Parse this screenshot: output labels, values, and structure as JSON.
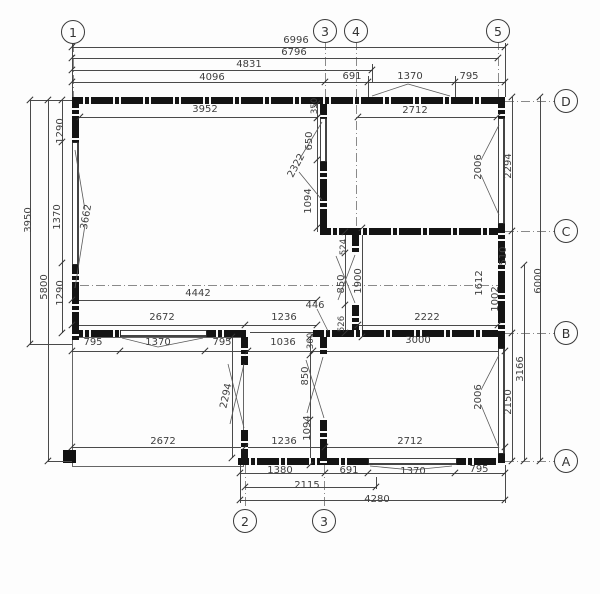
{
  "drawing_type": "floor-plan",
  "grid": {
    "g1": "1",
    "g3": "3",
    "g4": "4",
    "g5": "5",
    "b2": "2",
    "b3": "3",
    "rD": "D",
    "rC": "C",
    "rB": "B",
    "rA": "A"
  },
  "dims": {
    "t6996": "6996",
    "t6796": "6796",
    "t4831": "4831",
    "t4096": "4096",
    "t691": "691",
    "t1370": "1370",
    "t795": "795",
    "t3952": "3952",
    "t2712": "2712",
    "l3950": "3950",
    "l5800": "5800",
    "l1290a": "1290",
    "l1370": "1370",
    "l1290b": "1290",
    "l3662": "3662",
    "c350": "350",
    "c650": "650",
    "c2322": "2322",
    "c1094": "1094",
    "m524": "524",
    "m850": "850",
    "m526": "526",
    "m1900": "1900",
    "m446": "446",
    "m1612": "1612",
    "r2006a": "2006",
    "r2294": "2294",
    "r510": "510",
    "r1002": "1002",
    "r6000": "6000",
    "r2006b": "2006",
    "r2150": "2150",
    "r3166": "3166",
    "b4442": "4442",
    "b2672": "2672",
    "b1236": "1236",
    "b2222": "2222",
    "b795a": "795",
    "b1370": "1370",
    "b795b": "795",
    "b1036": "1036",
    "b360": "360",
    "b3000": "3000",
    "g2294": "2294",
    "g850": "850",
    "g1094": "1094",
    "f2672": "2672",
    "f1236": "1236",
    "f2712": "2712",
    "f1380": "1380",
    "f691": "691",
    "f1370": "1370",
    "f795": "795",
    "f2115": "2115",
    "f4280": "4280"
  },
  "colors": {
    "wall": "#141414",
    "line": "#4a4a4a",
    "axis": "#8a8a8a",
    "text": "#3f3f3f"
  }
}
